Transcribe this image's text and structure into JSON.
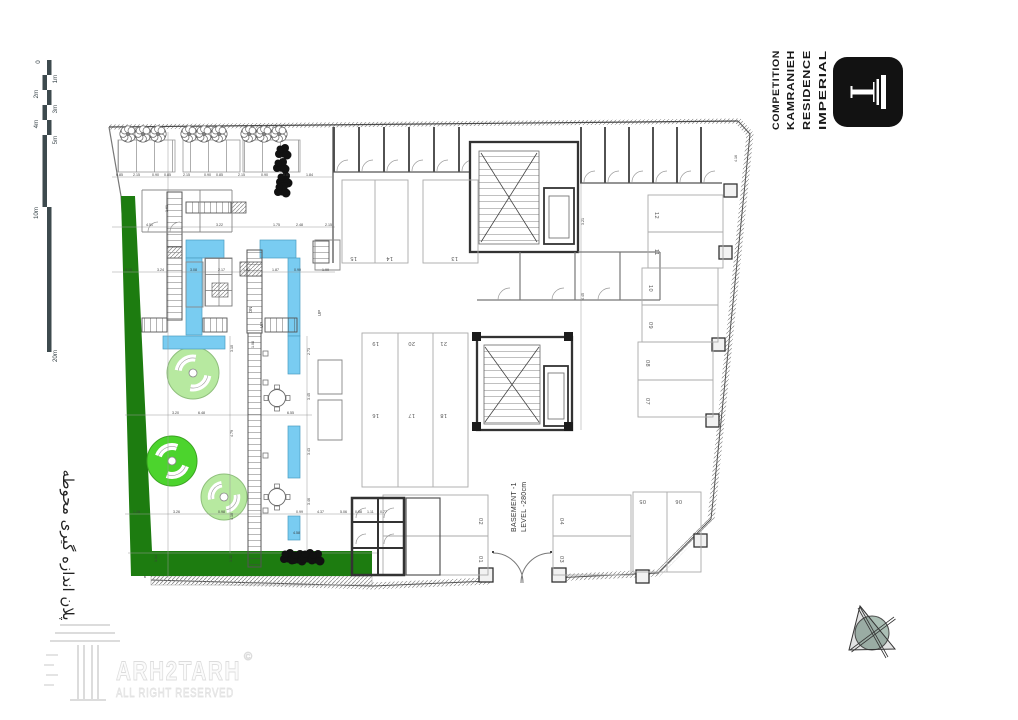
{
  "colors": {
    "dark_green": "#1d7c10",
    "bright_green": "#4cd42d",
    "light_green": "#b7e9a0",
    "water_blue": "#79ccf1",
    "wall": "#3f3f3f",
    "compass": "#abbfb5",
    "logo_black": "#121212"
  },
  "title_block": {
    "words": [
      {
        "t": "COMPETITION",
        "x": 779,
        "y": 130,
        "r": -90,
        "len": 80,
        "s": 9.5
      },
      {
        "t": "KAMRANIEH",
        "x": 794,
        "y": 130,
        "r": -90,
        "len": 80,
        "s": 10.5
      },
      {
        "t": "RESIDENCE",
        "x": 810,
        "y": 130,
        "r": -90,
        "len": 80,
        "s": 10.5
      },
      {
        "t": "IMPERIAL",
        "x": 826,
        "y": 130,
        "r": -90,
        "len": 80,
        "s": 10.5
      }
    ]
  },
  "scale_bar": {
    "labels": [
      {
        "t": "0",
        "x": 40,
        "y": 62,
        "r": -90
      },
      {
        "t": "1m",
        "x": 57,
        "y": 79,
        "r": -90
      },
      {
        "t": "2m",
        "x": 38,
        "y": 94,
        "r": -90
      },
      {
        "t": "3m",
        "x": 57,
        "y": 109,
        "r": -90
      },
      {
        "t": "4m",
        "x": 38,
        "y": 124,
        "r": -90
      },
      {
        "t": "5m",
        "x": 57,
        "y": 140,
        "r": -90
      },
      {
        "t": "10m",
        "x": 38,
        "y": 213,
        "r": -90
      },
      {
        "t": "20m",
        "x": 57,
        "y": 356,
        "r": -90
      }
    ]
  },
  "side_title": {
    "text": "پلان اندازه گیری محوطه"
  },
  "watermark": {
    "brand": "ARH2TARH",
    "copyright": "©",
    "tagline": "ALL RIGHT RESERVED"
  },
  "level_label": {
    "line1": "BASEMENT -1",
    "line2": "LEVEL -280cm"
  },
  "plan": {
    "parking_numbers": [
      {
        "t": "01",
        "x": 479,
        "y": 556,
        "r": 90
      },
      {
        "t": "02",
        "x": 479,
        "y": 518,
        "r": 90
      },
      {
        "t": "03",
        "x": 560,
        "y": 556,
        "r": 90
      },
      {
        "t": "04",
        "x": 560,
        "y": 518,
        "r": 90
      },
      {
        "t": "05",
        "x": 646,
        "y": 500,
        "r": 180
      },
      {
        "t": "06",
        "x": 682,
        "y": 500,
        "r": 180
      },
      {
        "t": "07",
        "x": 646,
        "y": 398,
        "r": 90
      },
      {
        "t": "08",
        "x": 646,
        "y": 360,
        "r": 90
      },
      {
        "t": "09",
        "x": 649,
        "y": 322,
        "r": 90
      },
      {
        "t": "10",
        "x": 649,
        "y": 285,
        "r": 90
      },
      {
        "t": "11",
        "x": 655,
        "y": 249,
        "r": 90
      },
      {
        "t": "12",
        "x": 655,
        "y": 212,
        "r": 90
      },
      {
        "t": "13",
        "x": 458,
        "y": 257,
        "r": 180
      },
      {
        "t": "14",
        "x": 393,
        "y": 257,
        "r": 180
      },
      {
        "t": "15",
        "x": 357,
        "y": 257,
        "r": 180
      },
      {
        "t": "16",
        "x": 379,
        "y": 414,
        "r": 180
      },
      {
        "t": "17",
        "x": 415,
        "y": 414,
        "r": 180
      },
      {
        "t": "18",
        "x": 447,
        "y": 414,
        "r": 180
      },
      {
        "t": "19",
        "x": 379,
        "y": 342,
        "r": 180
      },
      {
        "t": "20",
        "x": 415,
        "y": 342,
        "r": 180
      },
      {
        "t": "21",
        "x": 447,
        "y": 342,
        "r": 180
      }
    ],
    "stair_labels": [
      {
        "t": "DN",
        "x": 252,
        "y": 313,
        "r": -90
      },
      {
        "t": "UP",
        "x": 263,
        "y": 328,
        "r": -90
      },
      {
        "t": "UP",
        "x": 321,
        "y": 316,
        "r": -90
      }
    ],
    "dims": [
      {
        "t": "0.85",
        "x": 116,
        "y": 176
      },
      {
        "t": "2.15",
        "x": 133,
        "y": 176
      },
      {
        "t": "0.90",
        "x": 152,
        "y": 176
      },
      {
        "t": "0.85",
        "x": 164,
        "y": 176
      },
      {
        "t": "2.15",
        "x": 183,
        "y": 176
      },
      {
        "t": "0.90",
        "x": 204,
        "y": 176
      },
      {
        "t": "0.85",
        "x": 216,
        "y": 176
      },
      {
        "t": "2.15",
        "x": 238,
        "y": 176
      },
      {
        "t": "0.90",
        "x": 261,
        "y": 176
      },
      {
        "t": "0.80",
        "x": 283,
        "y": 176
      },
      {
        "t": "1.84",
        "x": 306,
        "y": 176
      },
      {
        "t": "4.51",
        "x": 146,
        "y": 226
      },
      {
        "t": "3.22",
        "x": 216,
        "y": 226
      },
      {
        "t": "1.75",
        "x": 273,
        "y": 226
      },
      {
        "t": "2.48",
        "x": 296,
        "y": 226
      },
      {
        "t": "2.15",
        "x": 325,
        "y": 226
      },
      {
        "t": "5.15",
        "x": 125,
        "y": 271
      },
      {
        "t": "3.24",
        "x": 157,
        "y": 271
      },
      {
        "t": "3.08",
        "x": 190,
        "y": 271
      },
      {
        "t": "2.17",
        "x": 218,
        "y": 271
      },
      {
        "t": "1.02",
        "x": 243,
        "y": 271
      },
      {
        "t": "1.87",
        "x": 272,
        "y": 271
      },
      {
        "t": "0.90",
        "x": 294,
        "y": 271
      },
      {
        "t": "1.99",
        "x": 322,
        "y": 271
      },
      {
        "t": "3.20",
        "x": 172,
        "y": 414
      },
      {
        "t": "6.48",
        "x": 198,
        "y": 414
      },
      {
        "t": "6.55",
        "x": 287,
        "y": 414
      },
      {
        "t": "1.28",
        "x": 133,
        "y": 513
      },
      {
        "t": "3.26",
        "x": 173,
        "y": 513
      },
      {
        "t": "0.98",
        "x": 218,
        "y": 513
      },
      {
        "t": "0.99",
        "x": 296,
        "y": 513
      },
      {
        "t": "4.37",
        "x": 317,
        "y": 513
      },
      {
        "t": "5.06",
        "x": 340,
        "y": 513
      },
      {
        "t": "0.88",
        "x": 355,
        "y": 513
      },
      {
        "t": "1.11",
        "x": 367,
        "y": 513
      },
      {
        "t": "0.77",
        "x": 380,
        "y": 513
      },
      {
        "t": "4.58",
        "x": 293,
        "y": 534
      },
      {
        "t": "3.10",
        "x": 233,
        "y": 352,
        "r": -90
      },
      {
        "t": "4.79",
        "x": 233,
        "y": 437,
        "r": -90
      },
      {
        "t": "4.10",
        "x": 233,
        "y": 520,
        "r": -90
      },
      {
        "t": "2.73",
        "x": 310,
        "y": 355,
        "r": -90
      },
      {
        "t": "3.45",
        "x": 310,
        "y": 400,
        "r": -90
      },
      {
        "t": "3.43",
        "x": 310,
        "y": 455,
        "r": -90
      },
      {
        "t": "3.46",
        "x": 310,
        "y": 505,
        "r": -90
      },
      {
        "t": "3.21",
        "x": 584,
        "y": 225,
        "r": -90
      },
      {
        "t": "4.45",
        "x": 584,
        "y": 300,
        "r": -90
      },
      {
        "t": "4.16",
        "x": 737,
        "y": 162,
        "r": -90
      },
      {
        "t": "3.61",
        "x": 168,
        "y": 212,
        "r": -90
      },
      {
        "t": "1.08",
        "x": 254,
        "y": 348,
        "r": -90
      },
      {
        "t": "1.14",
        "x": 157,
        "y": 562,
        "r": -90
      },
      {
        "t": "1.32",
        "x": 232,
        "y": 562,
        "r": -90
      }
    ],
    "trees": [
      {
        "x": 128,
        "y": 134
      },
      {
        "x": 143,
        "y": 134
      },
      {
        "x": 158,
        "y": 134
      },
      {
        "x": 189,
        "y": 134
      },
      {
        "x": 204,
        "y": 134
      },
      {
        "x": 219,
        "y": 134
      },
      {
        "x": 249,
        "y": 134
      },
      {
        "x": 264,
        "y": 134
      },
      {
        "x": 279,
        "y": 134
      }
    ],
    "dark_trees": [
      {
        "x": 283,
        "y": 152
      },
      {
        "x": 281,
        "y": 166
      },
      {
        "x": 284,
        "y": 180
      },
      {
        "x": 282,
        "y": 190
      },
      {
        "x": 288,
        "y": 557
      },
      {
        "x": 298,
        "y": 558
      },
      {
        "x": 308,
        "y": 557
      },
      {
        "x": 316,
        "y": 558
      }
    ],
    "tables": [
      {
        "x": 277,
        "y": 398
      },
      {
        "x": 277,
        "y": 497
      }
    ]
  }
}
